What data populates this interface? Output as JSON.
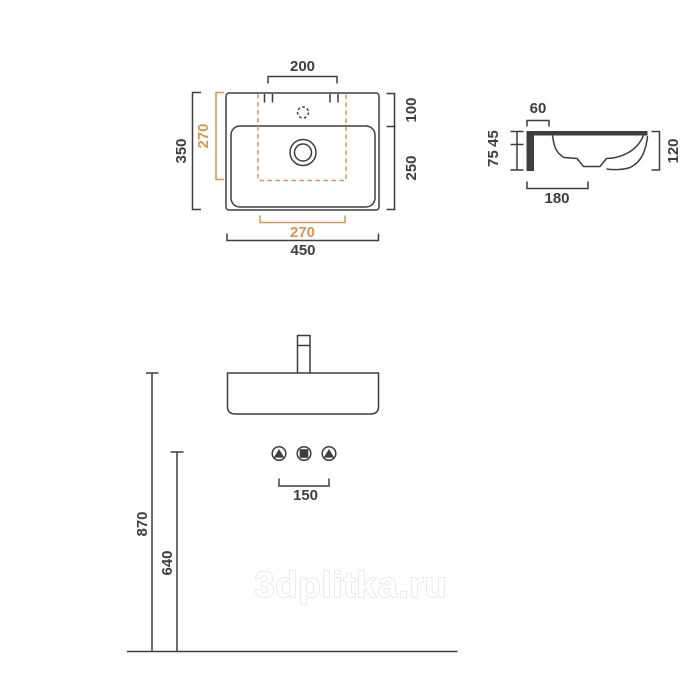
{
  "colors": {
    "ink": "#3e3e40",
    "accent": "#d9964f"
  },
  "plan_view": {
    "tap_hole_spacing": "200",
    "cutout_width": "270",
    "cutout_depth": "270",
    "overall_depth": "350",
    "deck_depth": "100",
    "basin_depth": "250",
    "overall_width": "450"
  },
  "side_view": {
    "back_ledge_width": "60",
    "rim_to_ledge": "45",
    "ledge_to_bottom": "75",
    "overall_height": "120",
    "overall_depth": "180"
  },
  "front_view": {
    "connection_spacing": "150",
    "rim_height_from_floor": "870",
    "connection_height_from_floor": "640"
  },
  "watermark": "3dplitka.ru"
}
